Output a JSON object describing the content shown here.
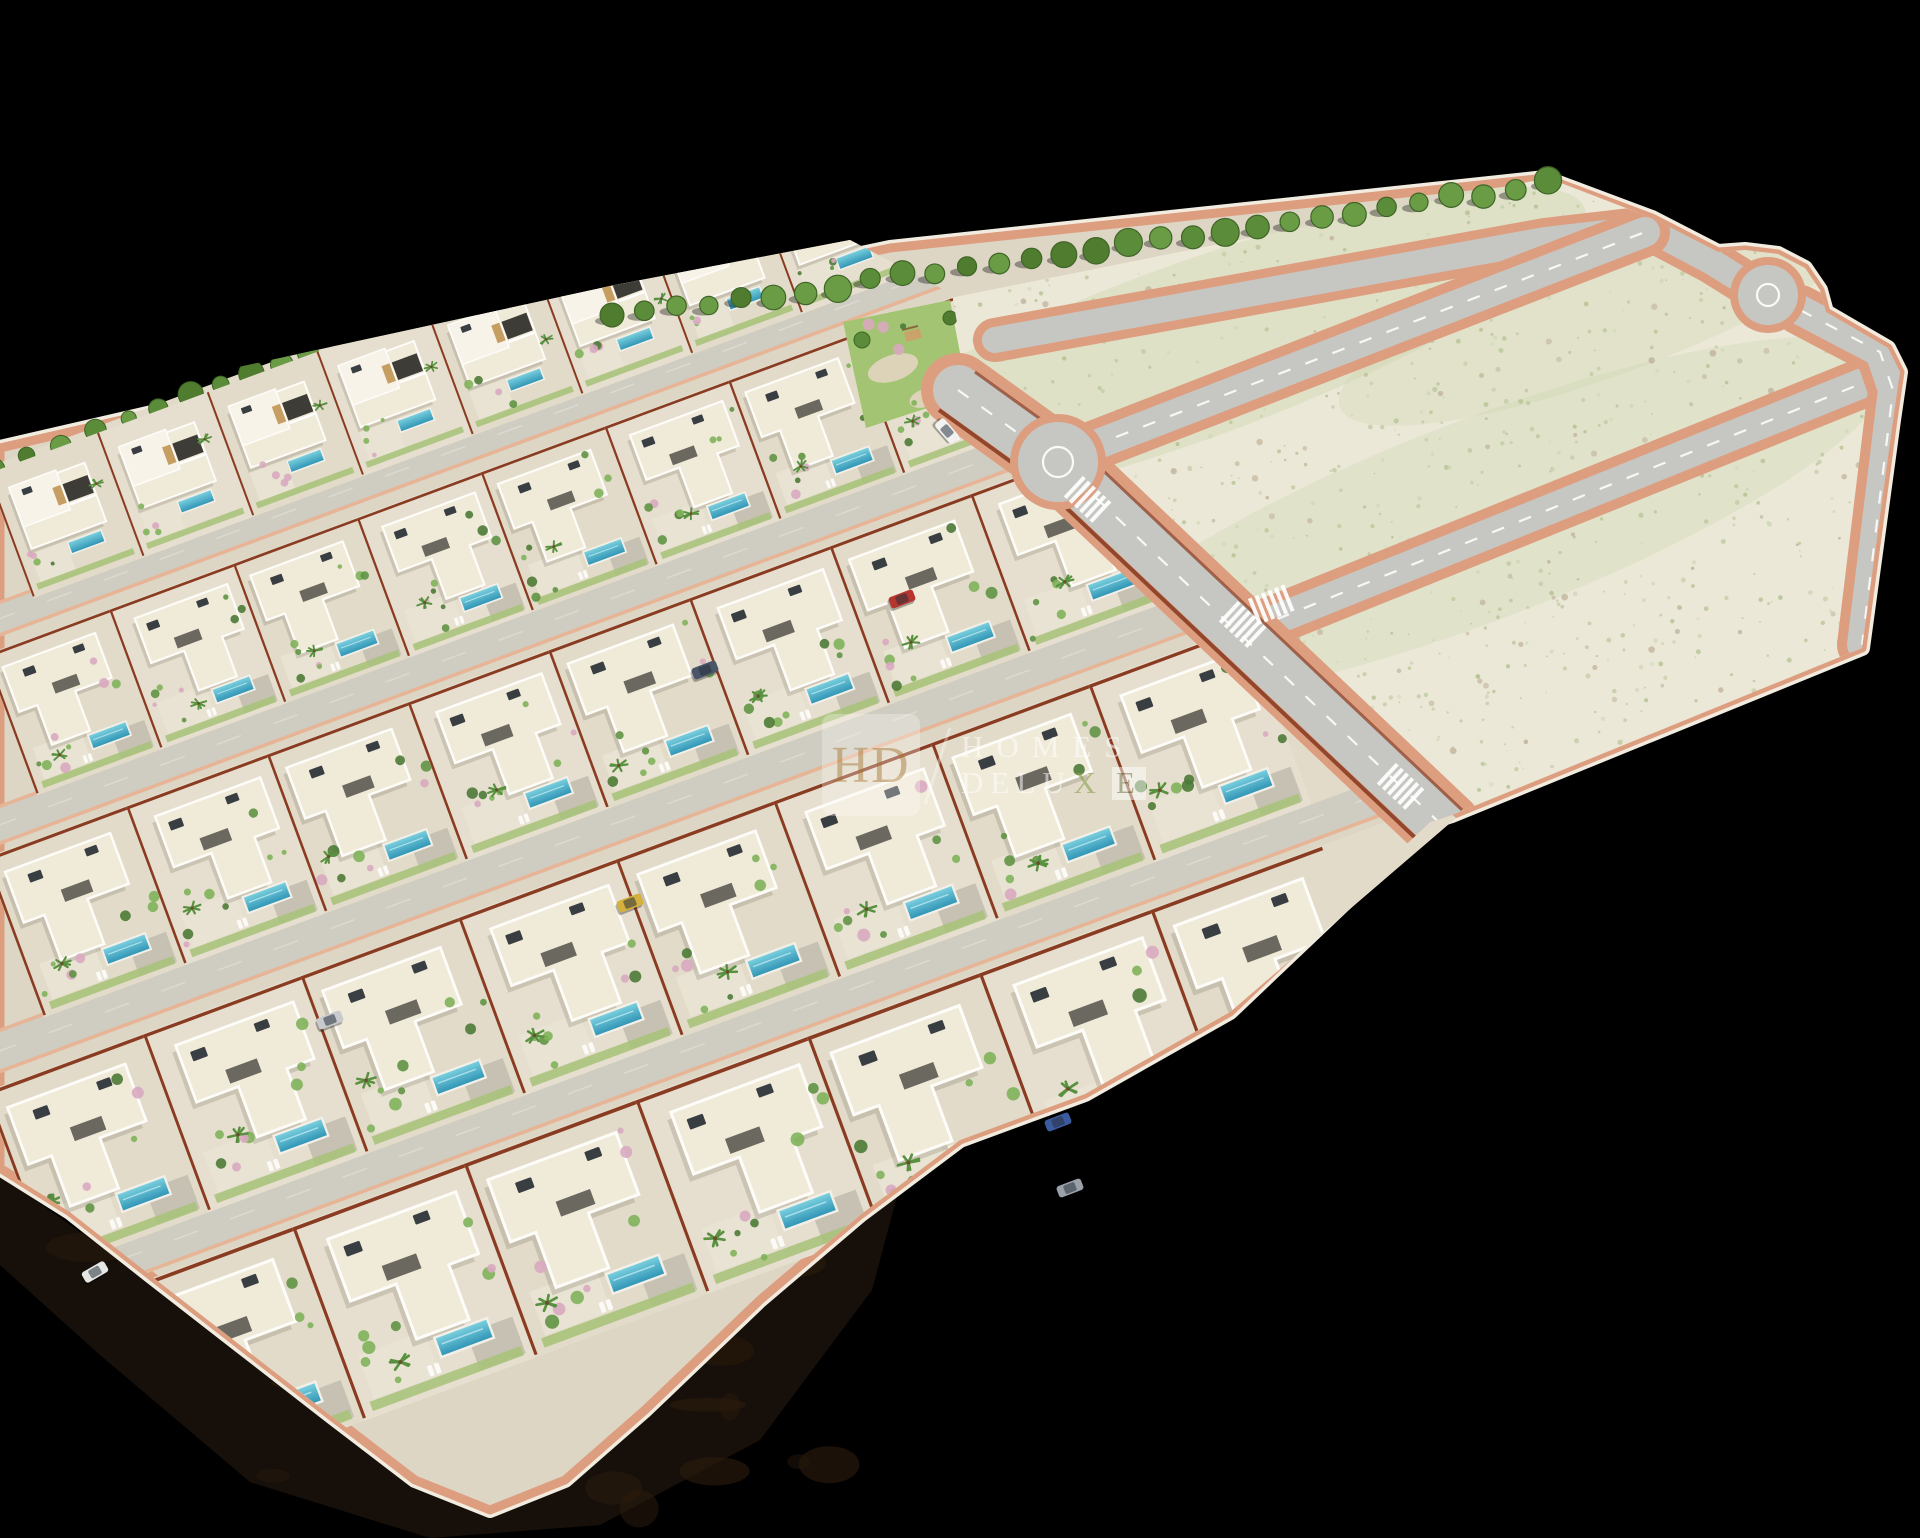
{
  "watermark": {
    "monogram": "HD",
    "line1": "HOMES",
    "line2_part1": "DELU",
    "line2_x": "X",
    "line2_e": "E",
    "hd_color": "#bb9660",
    "badge_bg": "rgba(252,250,245,0.50)",
    "text_color": "rgba(255,255,255,0.85)",
    "x_color": "#8da353",
    "ebox_bg": "rgba(255,255,255,0.80)",
    "ebox_color": "rgba(130,138,100,0.95)",
    "slash_color": "rgba(255,255,255,0.55)"
  },
  "colors": {
    "bg": "#000000",
    "sand": "#ddd6c5",
    "row_ground": "#e2dbc9",
    "row_ground_alt": "#e6dfcf",
    "land": "#ece8d8",
    "land_tint": "#c8d3a8",
    "asphalt": "#c6c7c3",
    "paver": "#cfccc2",
    "salmon": "#dd9e80",
    "salmon_bright": "#e8b292",
    "rust": "#8a3c22",
    "white_wall": "#f2ece0",
    "building": "#f0ead9",
    "building_hi": "#f7f3e9",
    "parapet": "#fdfcf8",
    "opening": "#3e3c36",
    "wood": "#c79e62",
    "roof_unit": "#393e42",
    "pool_light": "#7dd2e0",
    "pool_dark": "#2e93b4",
    "lawn": "#a6c277",
    "terrace": "#e9e3d3",
    "driveway": "#c6c1b2",
    "bush1": "#7fb25a",
    "bush2": "#5f9444",
    "bush3": "#4c7a36",
    "bush_pink": "#d9a8c0",
    "palm": "#58913f",
    "tree1": "#4f7c2f",
    "tree2": "#5b8c39",
    "tree3": "#6a9c46",
    "tree_stroke": "#3f6526",
    "scrub": "#b3c292",
    "scrub2": "#cfd8b8",
    "stone": "#bfb29a",
    "earth": "#17100a",
    "earth2": "#2a1b0c",
    "shadow": "rgba(60,55,40,0.16)",
    "park_lawn": "#a3c573",
    "park_path": "#ddd3b8"
  },
  "plate": {
    "outline": [
      [
        0,
        448
      ],
      [
        620,
        305
      ],
      [
        890,
        248
      ],
      [
        1545,
        178
      ],
      [
        1652,
        218
      ],
      [
        1718,
        252
      ],
      [
        1745,
        250
      ],
      [
        1778,
        254
      ],
      [
        1805,
        268
      ],
      [
        1820,
        290
      ],
      [
        1826,
        312
      ],
      [
        1888,
        348
      ],
      [
        1900,
        372
      ],
      [
        1893,
        420
      ],
      [
        1862,
        648
      ],
      [
        1452,
        815
      ],
      [
        1430,
        822
      ],
      [
        1230,
        1012
      ],
      [
        1085,
        1094
      ],
      [
        960,
        1140
      ],
      [
        860,
        1215
      ],
      [
        760,
        1300
      ],
      [
        645,
        1410
      ],
      [
        565,
        1480
      ],
      [
        490,
        1510
      ],
      [
        415,
        1480
      ],
      [
        330,
        1415
      ],
      [
        240,
        1345
      ],
      [
        150,
        1275
      ],
      [
        70,
        1212
      ],
      [
        0,
        1168
      ]
    ],
    "villa_clip": [
      [
        -5,
        420
      ],
      [
        615,
        285
      ],
      [
        850,
        240
      ],
      [
        952,
        294
      ],
      [
        970,
        398
      ],
      [
        1068,
        456
      ],
      [
        1456,
        818
      ],
      [
        1230,
        1012
      ],
      [
        1085,
        1094
      ],
      [
        960,
        1140
      ],
      [
        860,
        1215
      ],
      [
        760,
        1300
      ],
      [
        645,
        1410
      ],
      [
        565,
        1480
      ],
      [
        490,
        1510
      ],
      [
        415,
        1480
      ],
      [
        330,
        1415
      ],
      [
        240,
        1345
      ],
      [
        150,
        1275
      ],
      [
        70,
        1212
      ],
      [
        0,
        1168
      ]
    ],
    "land": [
      [
        950,
        298
      ],
      [
        1548,
        178
      ],
      [
        1652,
        218
      ],
      [
        1718,
        252
      ],
      [
        1745,
        250
      ],
      [
        1778,
        254
      ],
      [
        1805,
        268
      ],
      [
        1820,
        290
      ],
      [
        1826,
        312
      ],
      [
        1888,
        348
      ],
      [
        1900,
        372
      ],
      [
        1893,
        420
      ],
      [
        1862,
        648
      ],
      [
        1452,
        815
      ],
      [
        1062,
        462
      ],
      [
        968,
        395
      ]
    ],
    "earth": [
      [
        0,
        1175
      ],
      [
        150,
        1282
      ],
      [
        330,
        1420
      ],
      [
        490,
        1515
      ],
      [
        645,
        1415
      ],
      [
        760,
        1305
      ],
      [
        900,
        1185
      ],
      [
        872,
        1290
      ],
      [
        760,
        1440
      ],
      [
        600,
        1525
      ],
      [
        430,
        1538
      ],
      [
        250,
        1482
      ],
      [
        100,
        1355
      ],
      [
        0,
        1265
      ]
    ],
    "park": [
      [
        843,
        322
      ],
      [
        950,
        300
      ],
      [
        968,
        395
      ],
      [
        866,
        428
      ]
    ]
  },
  "row_angle": -20.3,
  "rows": [
    {
      "ax": -15,
      "ay": 468,
      "len": 940,
      "s": 0.78,
      "type": "duplex",
      "trees": true
    },
    {
      "ax": -15,
      "ay": 655,
      "len": 1075,
      "s": 0.88,
      "type": "villa"
    },
    {
      "ax": -15,
      "ay": 858,
      "len": 1250,
      "s": 1.0,
      "type": "villa"
    },
    {
      "ax": -15,
      "ay": 1092,
      "len": 1430,
      "s": 1.12,
      "type": "villa"
    },
    {
      "ax": 120,
      "ay": 1290,
      "len": 1420,
      "s": 1.22,
      "type": "villa"
    }
  ],
  "streets": [
    {
      "ax": -15,
      "ay": 606,
      "len": 1090,
      "t": 34
    },
    {
      "ax": -15,
      "ay": 810,
      "len": 1180,
      "t": 38
    },
    {
      "ax": -15,
      "ay": 1034,
      "len": 1330,
      "t": 42
    },
    {
      "ax": 110,
      "ay": 1240,
      "len": 1400,
      "t": 44
    }
  ],
  "roads": {
    "cross": {
      "path": [
        [
          958,
          390
        ],
        [
          1058,
          462
        ],
        [
          1445,
          828
        ]
      ],
      "casing": 74,
      "width": 50,
      "dashes": true
    },
    "top": {
      "path": [
        [
          995,
          340
        ],
        [
          1545,
          240
        ],
        [
          1648,
          228
        ],
        [
          1712,
          262
        ],
        [
          1760,
          292
        ]
      ],
      "casing": 44,
      "width": 26,
      "dashes": false
    },
    "r1": {
      "path": [
        [
          1062,
          458
        ],
        [
          1645,
          232
        ]
      ],
      "casing": 50,
      "width": 30,
      "dashes": true
    },
    "r2": {
      "path": [
        [
          1250,
          630
        ],
        [
          1890,
          372
        ]
      ],
      "casing": 50,
      "width": 30,
      "dashes": true
    },
    "right": {
      "path": [
        [
          1800,
          310
        ],
        [
          1880,
          352
        ],
        [
          1893,
          390
        ],
        [
          1862,
          645
        ]
      ],
      "casing": 50,
      "width": 30,
      "dashes": true
    }
  },
  "roundabouts": [
    {
      "x": 1058,
      "y": 462,
      "r": 40,
      "ring": 15
    },
    {
      "x": 1768,
      "y": 295,
      "r": 30,
      "ring": 11
    }
  ],
  "crosswalks": [
    {
      "x": 1085,
      "y": 497,
      "a": 43
    },
    {
      "x": 1240,
      "y": 622,
      "a": 43
    },
    {
      "x": 1398,
      "y": 784,
      "a": 43
    },
    {
      "x": 1268,
      "y": 606,
      "a": -22
    }
  ],
  "tree_row": {
    "from": [
      612,
      318
    ],
    "to": [
      1548,
      184
    ],
    "count": 30
  },
  "strip_tints": [
    {
      "cx": 1190,
      "cy": 352,
      "rx": 420,
      "ry": 88,
      "rot": -20,
      "op": 0.35
    },
    {
      "cx": 1480,
      "cy": 520,
      "rx": 440,
      "ry": 100,
      "rot": -21,
      "op": 0.3
    },
    {
      "cx": 1620,
      "cy": 300,
      "rx": 300,
      "ry": 70,
      "rot": -21,
      "op": 0.28
    }
  ],
  "scrub": {
    "count": 760,
    "bbox": [
      900,
      175,
      1905,
      820
    ]
  },
  "cars": [
    {
      "x": 947,
      "y": 431,
      "a": 49,
      "c": "#f2f3f1"
    },
    {
      "x": 902,
      "y": 599,
      "a": -21,
      "c": "#b5362e"
    },
    {
      "x": 630,
      "y": 903,
      "a": -21,
      "c": "#d3b13c"
    },
    {
      "x": 95,
      "y": 1272,
      "a": -30,
      "c": "#e6e7e5"
    },
    {
      "x": 330,
      "y": 1020,
      "a": -21,
      "c": "#c8cbcd"
    },
    {
      "x": 1070,
      "y": 1188,
      "a": -21,
      "c": "#9aa1a8"
    },
    {
      "x": 1058,
      "y": 1122,
      "a": -21,
      "c": "#3c5a9e"
    },
    {
      "x": 705,
      "y": 670,
      "a": -21,
      "c": "#4a5668"
    }
  ]
}
